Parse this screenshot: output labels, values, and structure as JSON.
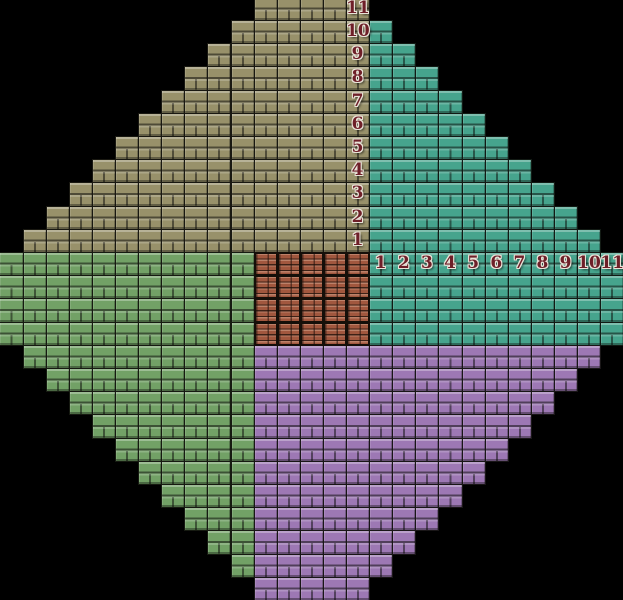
{
  "figure": {
    "name": "taxicab-diamond-tile-figure",
    "width": 623,
    "height": 600,
    "background": "#000000",
    "grid": {
      "cols": 27,
      "rows": 26,
      "tile_w": 23.11,
      "tile_h": 23.2,
      "offset_x": -0.6,
      "offset_y": -3.2,
      "grout_color": "#12100c"
    },
    "quadrants": [
      {
        "id": "olive",
        "name": "top-left-quadrant",
        "orientation": "rows",
        "base_color": "#98916a",
        "runs": [
          [
            0,
            11,
            15
          ],
          [
            1,
            10,
            15
          ],
          [
            2,
            9,
            15
          ],
          [
            3,
            8,
            15
          ],
          [
            4,
            7,
            15
          ],
          [
            5,
            6,
            15
          ],
          [
            6,
            5,
            15
          ],
          [
            7,
            4,
            15
          ],
          [
            8,
            3,
            15
          ],
          [
            9,
            2,
            15
          ],
          [
            10,
            1,
            15
          ]
        ]
      },
      {
        "id": "teal",
        "name": "top-right-quadrant",
        "orientation": "cols",
        "base_color": "#46a48d",
        "runs": [
          [
            16,
            1,
            14
          ],
          [
            17,
            2,
            14
          ],
          [
            18,
            3,
            14
          ],
          [
            19,
            4,
            14
          ],
          [
            20,
            5,
            14
          ],
          [
            21,
            6,
            14
          ],
          [
            22,
            7,
            14
          ],
          [
            23,
            8,
            14
          ],
          [
            24,
            9,
            14
          ],
          [
            25,
            10,
            14
          ],
          [
            26,
            11,
            14
          ]
        ]
      },
      {
        "id": "green",
        "name": "bottom-left-quadrant",
        "orientation": "cols",
        "base_color": "#72a166",
        "runs": [
          [
            0,
            11,
            14
          ],
          [
            1,
            11,
            15
          ],
          [
            2,
            11,
            16
          ],
          [
            3,
            11,
            17
          ],
          [
            4,
            11,
            18
          ],
          [
            5,
            11,
            19
          ],
          [
            6,
            11,
            20
          ],
          [
            7,
            11,
            21
          ],
          [
            8,
            11,
            22
          ],
          [
            9,
            11,
            23
          ],
          [
            10,
            11,
            24
          ]
        ]
      },
      {
        "id": "purple",
        "name": "bottom-right-quadrant",
        "orientation": "rows",
        "base_color": "#9d78b4",
        "runs": [
          [
            15,
            11,
            25
          ],
          [
            16,
            11,
            24
          ],
          [
            17,
            11,
            23
          ],
          [
            18,
            11,
            22
          ],
          [
            19,
            11,
            21
          ],
          [
            20,
            11,
            20
          ],
          [
            21,
            11,
            19
          ],
          [
            22,
            11,
            18
          ],
          [
            23,
            11,
            17
          ],
          [
            24,
            11,
            16
          ],
          [
            25,
            11,
            15
          ]
        ]
      }
    ],
    "center": {
      "id": "brick",
      "name": "center-brick-block",
      "col_start": 11,
      "col_end": 15,
      "row_start": 11,
      "row_end": 14,
      "base_color": "#a1573e"
    },
    "axes": {
      "label_color": "#6e1f28",
      "outline_color": "#e9e3d8",
      "vertical": [
        {
          "label": "11",
          "col": 15,
          "row": 0
        },
        {
          "label": "10",
          "col": 15,
          "row": 1
        },
        {
          "label": "9",
          "col": 15,
          "row": 2
        },
        {
          "label": "8",
          "col": 15,
          "row": 3
        },
        {
          "label": "7",
          "col": 15,
          "row": 4
        },
        {
          "label": "6",
          "col": 15,
          "row": 5
        },
        {
          "label": "5",
          "col": 15,
          "row": 6
        },
        {
          "label": "4",
          "col": 15,
          "row": 7
        },
        {
          "label": "3",
          "col": 15,
          "row": 8
        },
        {
          "label": "2",
          "col": 15,
          "row": 9
        },
        {
          "label": "1",
          "col": 15,
          "row": 10
        }
      ],
      "horizontal": [
        {
          "label": "1",
          "col": 16,
          "row": 11
        },
        {
          "label": "2",
          "col": 17,
          "row": 11
        },
        {
          "label": "3",
          "col": 18,
          "row": 11
        },
        {
          "label": "4",
          "col": 19,
          "row": 11
        },
        {
          "label": "5",
          "col": 20,
          "row": 11
        },
        {
          "label": "6",
          "col": 21,
          "row": 11
        },
        {
          "label": "7",
          "col": 22,
          "row": 11
        },
        {
          "label": "8",
          "col": 23,
          "row": 11
        },
        {
          "label": "9",
          "col": 24,
          "row": 11
        },
        {
          "label": "10",
          "col": 25,
          "row": 11
        },
        {
          "label": "11",
          "col": 26,
          "row": 11
        }
      ]
    }
  }
}
